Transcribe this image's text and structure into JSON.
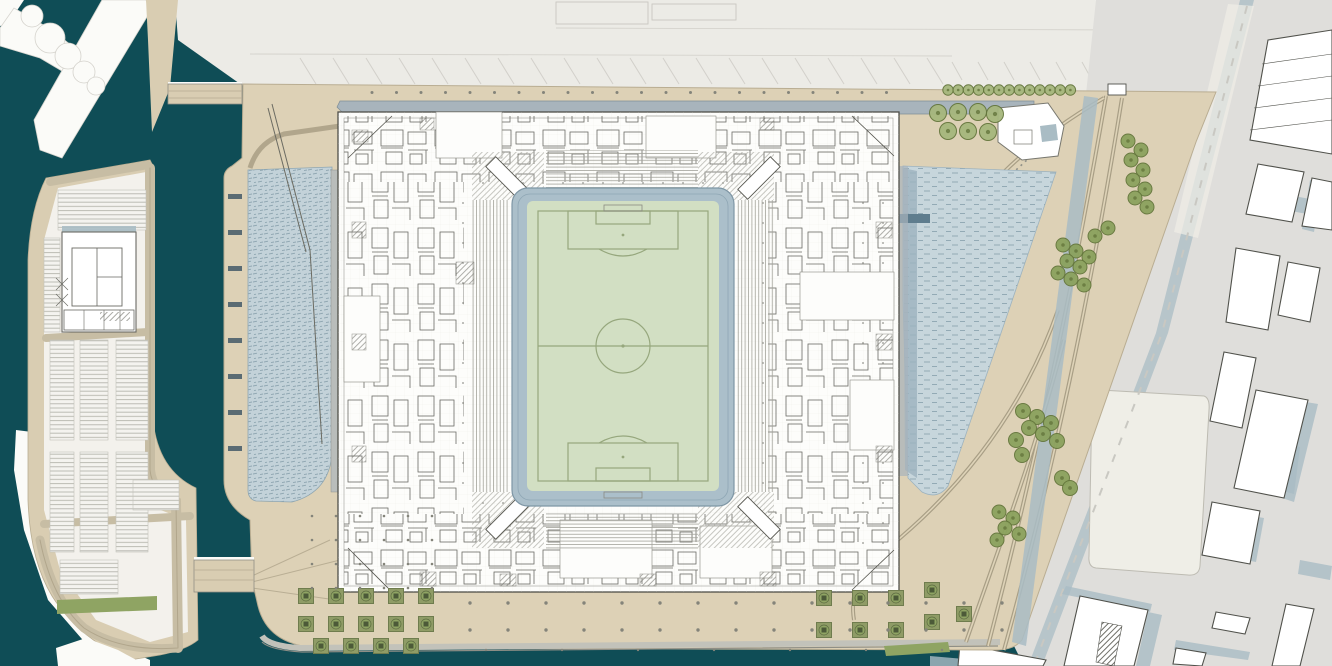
{
  "colors": {
    "water_dark": "#0f4d56",
    "water_dock": "#c7d6dc",
    "water_dock_edge": "#9db3bf",
    "water_west": "#c3d2d9",
    "plaza_tan": "#ddd1b6",
    "pier_tan": "#d9cdb2",
    "pier_field": "#f3f1ec",
    "quay_white": "#fbfbf8",
    "dock_top": "#ecebe6",
    "dock_top_light": "#f1f0ed",
    "urban_base": "#dfdedb",
    "building_white": "#ffffff",
    "building_outline": "#50514b",
    "shadow_blue": "#a9bcc4",
    "channel_band": "#a8b4bc",
    "stadium_white": "#fdfdfb",
    "stadium_line": "#4f4f49",
    "pitch_green": "#d2dfc3",
    "pitch_line": "#96a77d",
    "surround_blue": "#abbfca",
    "surround_edge": "#7e96a5",
    "tree_green": "#8ba25e",
    "tree_ring": "#64763c",
    "tree_light": "#a6b77d",
    "planter_green": "#8f9c66",
    "planter_dark": "#4c5a38",
    "grass_verge": "#8fa463",
    "road_line": "#b1a68c",
    "track_line": "#a89e85",
    "track_fill": "#ded3b8",
    "parcel_pale": "#efeee7",
    "cream_building": "#e9e2d2",
    "jetty_dark": "#5f7d8e",
    "dolphin_dark": "#5a6b73",
    "dot_gray": "#84847a"
  },
  "features": {
    "tree_rows": [
      {
        "y": 90,
        "x0": 948,
        "x1": 1071,
        "step": 10.2,
        "r": 5.2,
        "shade": "light"
      }
    ],
    "tree_clusters": [
      {
        "r": 8.5,
        "shade": "light",
        "pts": [
          [
            938,
            113
          ],
          [
            958,
            112
          ],
          [
            978,
            112
          ],
          [
            995,
            114
          ],
          [
            948,
            131
          ],
          [
            968,
            131
          ],
          [
            988,
            132
          ]
        ]
      },
      {
        "r": 7,
        "shade": "dark",
        "pts": [
          [
            1128,
            141
          ],
          [
            1141,
            150
          ],
          [
            1131,
            160
          ],
          [
            1143,
            170
          ],
          [
            1133,
            180
          ],
          [
            1145,
            189
          ],
          [
            1135,
            198
          ],
          [
            1147,
            207
          ]
        ]
      },
      {
        "r": 7,
        "shade": "dark",
        "pts": [
          [
            1063,
            245
          ],
          [
            1076,
            251
          ],
          [
            1089,
            257
          ],
          [
            1067,
            261
          ],
          [
            1080,
            267
          ],
          [
            1058,
            273
          ],
          [
            1071,
            279
          ],
          [
            1084,
            285
          ],
          [
            1095,
            236
          ],
          [
            1108,
            228
          ]
        ]
      },
      {
        "r": 7.5,
        "shade": "dark",
        "pts": [
          [
            1023,
            411
          ],
          [
            1037,
            417
          ],
          [
            1051,
            423
          ],
          [
            1029,
            428
          ],
          [
            1043,
            434
          ],
          [
            1016,
            440
          ],
          [
            1057,
            441
          ],
          [
            1022,
            455
          ],
          [
            1062,
            478
          ],
          [
            1070,
            488
          ]
        ]
      },
      {
        "r": 7,
        "shade": "dark",
        "pts": [
          [
            999,
            512
          ],
          [
            1013,
            518
          ],
          [
            1005,
            528
          ],
          [
            1019,
            534
          ],
          [
            997,
            540
          ]
        ]
      }
    ],
    "planters": {
      "size": 15,
      "positions": [
        [
          306,
          596
        ],
        [
          336,
          596
        ],
        [
          366,
          596
        ],
        [
          396,
          596
        ],
        [
          426,
          596
        ],
        [
          306,
          624
        ],
        [
          336,
          624
        ],
        [
          366,
          624
        ],
        [
          396,
          624
        ],
        [
          426,
          624
        ],
        [
          321,
          646
        ],
        [
          351,
          646
        ],
        [
          381,
          646
        ],
        [
          411,
          646
        ],
        [
          824,
          598
        ],
        [
          860,
          598
        ],
        [
          896,
          598
        ],
        [
          824,
          630
        ],
        [
          860,
          630
        ],
        [
          896,
          630
        ],
        [
          932,
          590
        ],
        [
          932,
          622
        ],
        [
          964,
          614
        ]
      ]
    },
    "dot_rows": [
      {
        "y": 92.5,
        "x0": 372,
        "x1": 896,
        "step": 24.5,
        "r": 1.5
      },
      {
        "y": 603,
        "x0": 470,
        "x1": 1004,
        "step": 38,
        "r": 1.7
      },
      {
        "y": 630,
        "x0": 470,
        "x1": 1002,
        "step": 38,
        "r": 1.7
      },
      {
        "y": 650,
        "x0": 486,
        "x1": 990,
        "step": 76,
        "r": 1.2
      }
    ],
    "dot_grid": {
      "x0": 312,
      "x1": 436,
      "y0": 516,
      "y1": 588,
      "sx": 24,
      "sy": 24,
      "r": 1.3
    },
    "parking_groups": [
      [
        58,
        190,
        88,
        40
      ],
      [
        44,
        238,
        16,
        94
      ],
      [
        50,
        340,
        24,
        100
      ],
      [
        80,
        340,
        28,
        100
      ],
      [
        116,
        340,
        32,
        100
      ],
      [
        50,
        452,
        24,
        100
      ],
      [
        80,
        452,
        28,
        100
      ],
      [
        116,
        452,
        32,
        100
      ],
      [
        60,
        560,
        58,
        34
      ],
      [
        133,
        480,
        46,
        30
      ]
    ],
    "slant_sets": [
      {
        "x0": 300,
        "x1": 940,
        "step": 33,
        "y": 58,
        "dx": 16,
        "dy": 26
      },
      {
        "x0": 952,
        "x1": 1110,
        "step": 26,
        "y": 62,
        "dx": 10,
        "dy": 18
      }
    ],
    "urban_buildings": [
      "1268,40 1332,30 1332,154 1250,140",
      "1258,164 1304,172 1292,222 1246,214",
      "1312,178 1332,182 1332,230 1302,226",
      "1236,248 1280,256 1268,330 1226,322",
      "1288,262 1320,268 1310,322 1278,315",
      "1224,352 1256,358 1242,428 1210,421",
      "1256,390 1308,400 1284,498 1234,488",
      "1212,502 1260,511 1250,564 1202,555",
      "1286,604 1314,609 1300,666 1272,666",
      "1216,612 1250,618 1245,634 1212,628",
      "1080,596 1148,610 1134,666 1064,666",
      "960,644 1046,660 1043,666 958,666",
      "1176,648 1206,653 1202,666 1173,664"
    ],
    "urban_lines": [
      "1262,64 1332,54",
      "1258,86 1332,76",
      "1254,108 1332,98",
      "1250,130 1332,120"
    ],
    "urban_shadows": [
      "1306,402 1318,404 1294,502 1282,498",
      "1148,612 1162,615 1150,666 1136,666",
      "1252,516 1264,518 1256,562 1245,560",
      "1310,180 1322,182 1314,232 1302,229",
      "1294,196 1310,199 1307,214 1291,211",
      "1066,586 1152,604 1150,612 1062,594",
      "1176,640 1250,652 1248,660 1174,650",
      "1284,444 1300,447 1294,494 1279,490",
      "930,656 1044,666 930,666",
      "1300,560 1332,566 1330,580 1298,574"
    ],
    "hatch_pieces": [
      "1102,622 1122,626 1114,666 1096,662"
    ],
    "tracks": [
      {
        "d": "M1106,96 C1088,200 1052,400 988,646"
      },
      {
        "d": "M1122,98 C1104,210 1068,420 1004,650"
      },
      {
        "d": "M1058,310 C1020,420 950,500 878,556"
      },
      {
        "d": "M1064,340 C1036,450 998,550 966,642"
      },
      {
        "d": "M878,556 C858,574 850,596 854,620"
      },
      {
        "d": "M1104,98 C1062,122 1024,152 1004,172"
      }
    ],
    "dash_paths": [
      {
        "d": "M1062,128 L1016,170"
      }
    ],
    "road_dash": {
      "d": "M1247,6 L1162,333 L1036,660"
    },
    "dolphins": {
      "x": 228,
      "w": 14,
      "h": 5,
      "ys": [
        194,
        230,
        266,
        302,
        338,
        374,
        410,
        446
      ]
    },
    "halls": [
      [
        436,
        112,
        66,
        46
      ],
      [
        646,
        116,
        70,
        42
      ],
      [
        560,
        520,
        92,
        58
      ],
      [
        700,
        526,
        72,
        52
      ],
      [
        800,
        272,
        94,
        48
      ],
      [
        344,
        296,
        36,
        86
      ],
      [
        850,
        380,
        44,
        70
      ]
    ],
    "stairs": [
      [
        352,
        130,
        16,
        12
      ],
      [
        352,
        222,
        14,
        16
      ],
      [
        352,
        334,
        14,
        16
      ],
      [
        352,
        446,
        14,
        16
      ],
      [
        876,
        222,
        16,
        16
      ],
      [
        876,
        334,
        16,
        16
      ],
      [
        876,
        446,
        16,
        16
      ],
      [
        420,
        572,
        16,
        14
      ],
      [
        500,
        574,
        16,
        12
      ],
      [
        640,
        574,
        16,
        12
      ],
      [
        760,
        572,
        16,
        14
      ],
      [
        420,
        118,
        14,
        12
      ],
      [
        760,
        118,
        14,
        12
      ],
      [
        456,
        262,
        18,
        22
      ]
    ]
  }
}
